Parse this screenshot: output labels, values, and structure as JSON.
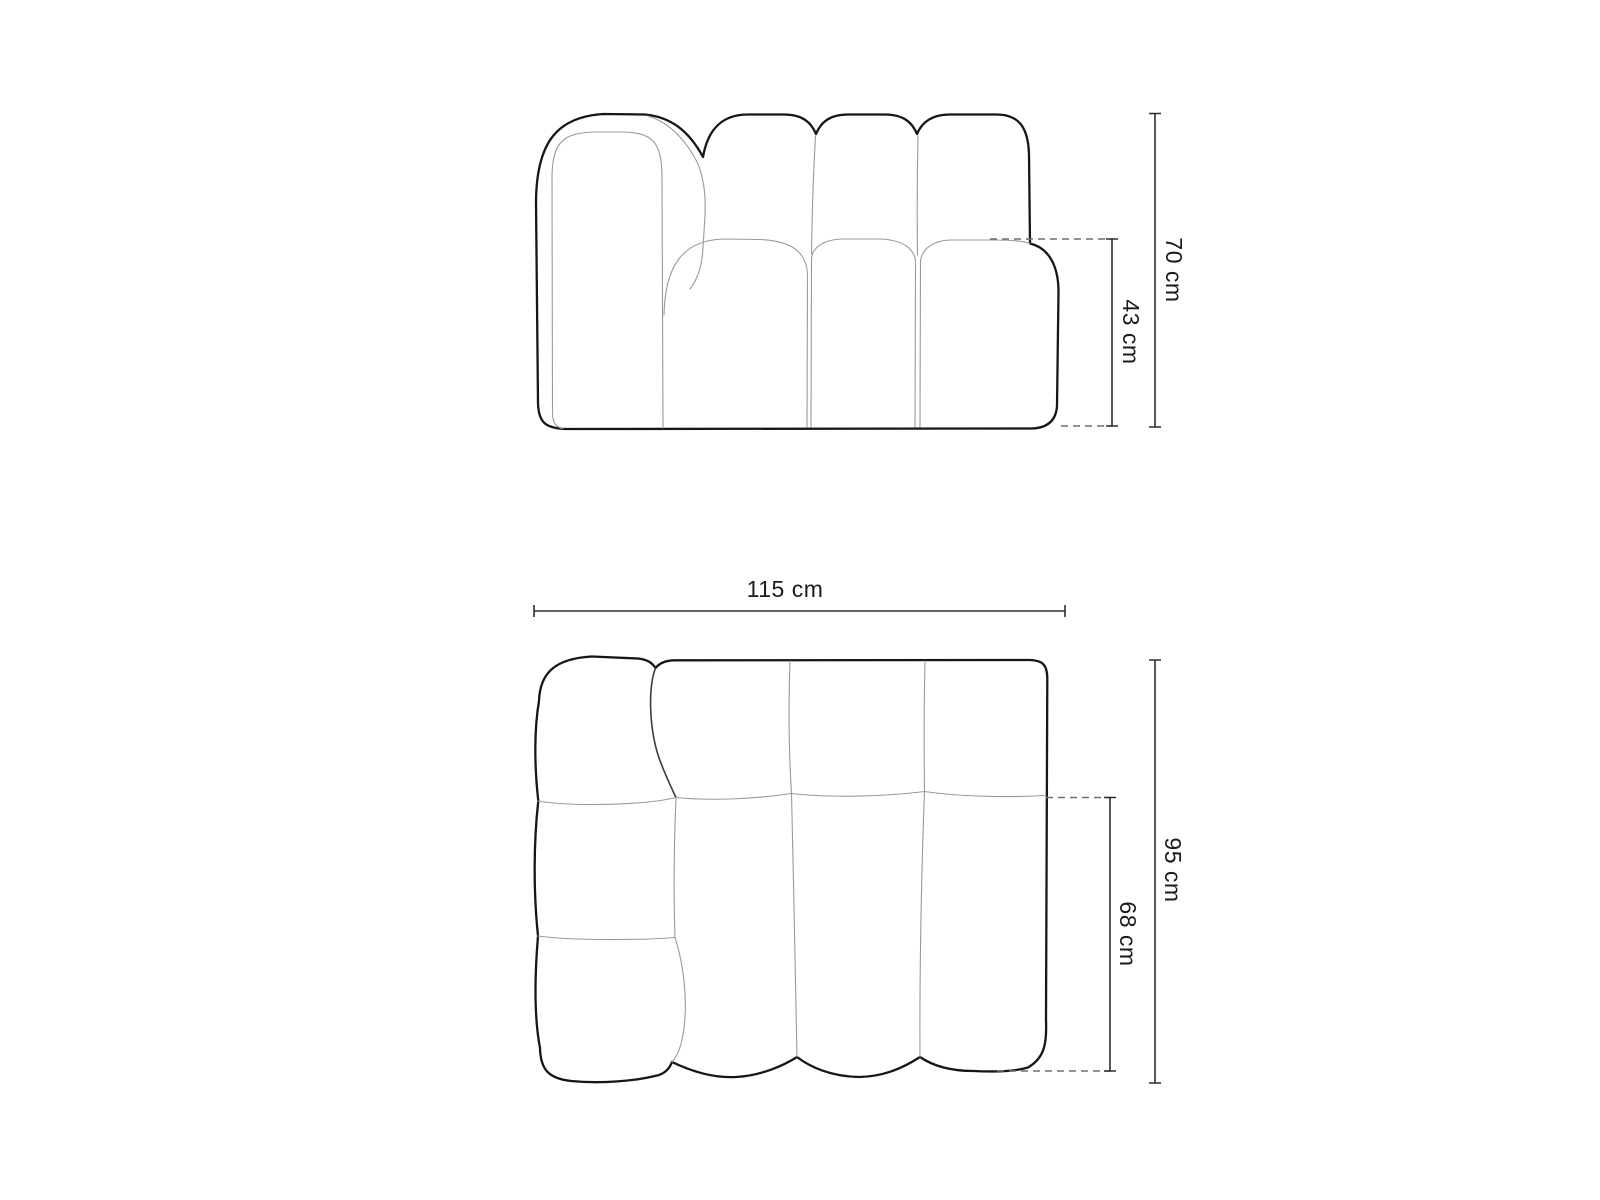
{
  "colors": {
    "background": "#ffffff",
    "outline": "#161616",
    "seam": "#9a9a9a",
    "seam_strong": "#3c3c3c",
    "dimension_line": "#2e2e2e",
    "dashed_line": "#6f6f6f",
    "label": "#1b1b1b"
  },
  "front_view": {
    "labels": {
      "total_height": "70 cm",
      "seat_height": "43 cm"
    }
  },
  "top_view": {
    "labels": {
      "width": "115 cm",
      "total_depth": "95 cm",
      "seat_depth": "68 cm"
    }
  }
}
